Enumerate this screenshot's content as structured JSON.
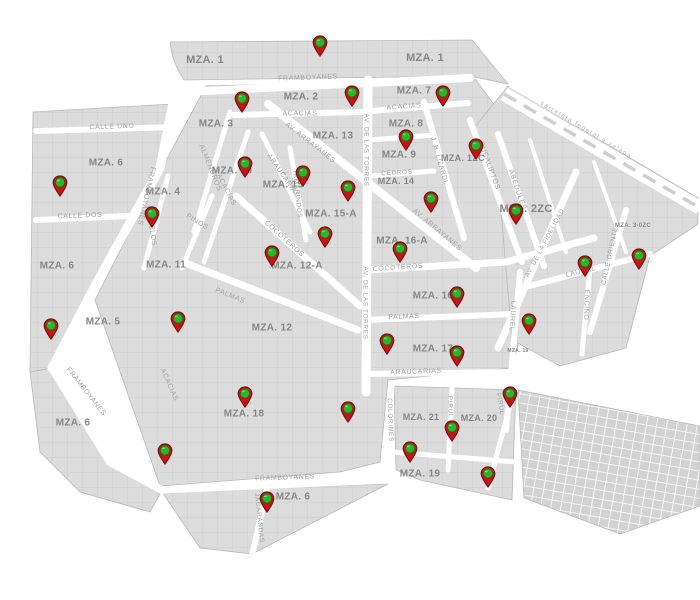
{
  "map": {
    "colors": {
      "background": "#ffffff",
      "block_fill": "#dcdcdc",
      "block_stroke": "#b8b8b8",
      "parcel_line": "#d3d3d3",
      "street": "#ffffff",
      "grid_cell": "#d2d2d2",
      "block_label": "#868686",
      "street_label": "#a2a2a2",
      "highway_label": "#b5b5b5",
      "pin_body": "#c81414",
      "pin_border": "#7d0f0f",
      "pin_dot": "#2db32d",
      "pin_dot_border": "#157a15"
    },
    "highway_label": {
      "text": "carretera federal a xalapa",
      "x": 586,
      "y": 130,
      "rotation": 31
    },
    "block_labels": [
      {
        "text": "MZA. 1",
        "x": 205,
        "y": 60,
        "size": 11
      },
      {
        "text": "MZA. 1",
        "x": 425,
        "y": 58,
        "size": 11
      },
      {
        "text": "MZA. 2",
        "x": 301,
        "y": 97,
        "size": 10
      },
      {
        "text": "MZA. 7",
        "x": 414,
        "y": 91,
        "size": 10
      },
      {
        "text": "MZA. 3",
        "x": 216,
        "y": 124,
        "size": 10
      },
      {
        "text": "MZA. 13",
        "x": 333,
        "y": 136,
        "size": 10
      },
      {
        "text": "MZA. 8",
        "x": 406,
        "y": 124,
        "size": 10
      },
      {
        "text": "MZA. 6",
        "x": 106,
        "y": 163,
        "size": 10
      },
      {
        "text": "MZA. 9",
        "x": 399,
        "y": 155,
        "size": 10
      },
      {
        "text": "MZA. 1ZC",
        "x": 463,
        "y": 158,
        "size": 9
      },
      {
        "text": "MZA. 4",
        "x": 163,
        "y": 192,
        "size": 10
      },
      {
        "text": "MZA. 10",
        "x": 232,
        "y": 171,
        "size": 10
      },
      {
        "text": "MZA. 15",
        "x": 283,
        "y": 185,
        "size": 10
      },
      {
        "text": "MZA. 14",
        "x": 396,
        "y": 181,
        "size": 9
      },
      {
        "text": "MZA. 2ZC",
        "x": 526,
        "y": 209,
        "size": 11
      },
      {
        "text": "MZA. 15-A",
        "x": 331,
        "y": 214,
        "size": 10
      },
      {
        "text": "MZA. 16-A",
        "x": 402,
        "y": 241,
        "size": 10
      },
      {
        "text": "MZA. 6",
        "x": 57,
        "y": 266,
        "size": 10
      },
      {
        "text": "MZA. 11",
        "x": 166,
        "y": 265,
        "size": 10
      },
      {
        "text": "MZA. 12-A",
        "x": 297,
        "y": 266,
        "size": 10
      },
      {
        "text": "MZA. 3-0ZC",
        "x": 633,
        "y": 226,
        "size": 6
      },
      {
        "text": "MZA. 16",
        "x": 433,
        "y": 296,
        "size": 10
      },
      {
        "text": "MZA. 5",
        "x": 103,
        "y": 322,
        "size": 10
      },
      {
        "text": "MZA. 12",
        "x": 272,
        "y": 328,
        "size": 10
      },
      {
        "text": "MZA. 17",
        "x": 433,
        "y": 349,
        "size": 10
      },
      {
        "text": "MZA. 19",
        "x": 518,
        "y": 351,
        "size": 5
      },
      {
        "text": "MZA. 6",
        "x": 73,
        "y": 423,
        "size": 10
      },
      {
        "text": "MZA. 18",
        "x": 244,
        "y": 414,
        "size": 10
      },
      {
        "text": "MZA. 21",
        "x": 421,
        "y": 417,
        "size": 9
      },
      {
        "text": "MZA. 20",
        "x": 479,
        "y": 418,
        "size": 9
      },
      {
        "text": "MZA. 19",
        "x": 420,
        "y": 474,
        "size": 10
      },
      {
        "text": "MZA. 6",
        "x": 293,
        "y": 497,
        "size": 10
      }
    ],
    "street_labels": [
      {
        "text": "FRAMBOYANES",
        "x": 308,
        "y": 78,
        "rotation": -2
      },
      {
        "text": "ACACIAS",
        "x": 300,
        "y": 114,
        "rotation": 0
      },
      {
        "text": "ACACIAS",
        "x": 404,
        "y": 107,
        "rotation": -4
      },
      {
        "text": "CALLE UNO",
        "x": 112,
        "y": 127,
        "rotation": -2
      },
      {
        "text": "CALLE DOS",
        "x": 80,
        "y": 216,
        "rotation": -2
      },
      {
        "text": "FRAMBOYANES",
        "x": 146,
        "y": 196,
        "rotation": 103
      },
      {
        "text": "CIRUELOS",
        "x": 151,
        "y": 226,
        "rotation": 82
      },
      {
        "text": "PINOS",
        "x": 197,
        "y": 222,
        "rotation": 32
      },
      {
        "text": "ALMENDROS",
        "x": 210,
        "y": 168,
        "rotation": 68
      },
      {
        "text": "ACACIAS",
        "x": 226,
        "y": 190,
        "rotation": 62
      },
      {
        "text": "ARAUCARIAS",
        "x": 283,
        "y": 176,
        "rotation": 55
      },
      {
        "text": "TAMARINDOS",
        "x": 297,
        "y": 194,
        "rotation": 84,
        "size": 6.5
      },
      {
        "text": "AV. ARRAYANES",
        "x": 310,
        "y": 143,
        "rotation": 38
      },
      {
        "text": "AV. ARRAYANES",
        "x": 437,
        "y": 230,
        "rotation": 40
      },
      {
        "text": "COCOTEROS",
        "x": 284,
        "y": 239,
        "rotation": 42
      },
      {
        "text": "PALMAS",
        "x": 230,
        "y": 296,
        "rotation": 22
      },
      {
        "text": "AV. DE LAS TORRES",
        "x": 366,
        "y": 150,
        "rotation": 90,
        "size": 6.5
      },
      {
        "text": "AV. DE LAS TORRES",
        "x": 365,
        "y": 303,
        "rotation": 90,
        "size": 6.5
      },
      {
        "text": "CEDROS",
        "x": 397,
        "y": 173,
        "rotation": -3,
        "size": 6.5
      },
      {
        "text": "COCOTEROS",
        "x": 398,
        "y": 268,
        "rotation": -4
      },
      {
        "text": "PALMAS",
        "x": 404,
        "y": 317,
        "rotation": -2
      },
      {
        "text": "ARAUCARIAS",
        "x": 416,
        "y": 372,
        "rotation": -2
      },
      {
        "text": "J. B. LIZARDI",
        "x": 439,
        "y": 160,
        "rotation": 74,
        "size": 6.5
      },
      {
        "text": "EUCALIPTOS",
        "x": 489,
        "y": 166,
        "rotation": 70
      },
      {
        "text": "ABEDULES",
        "x": 517,
        "y": 190,
        "rotation": 71
      },
      {
        "text": "AV. DE LA FIDELIDAD",
        "x": 545,
        "y": 243,
        "rotation": -62,
        "size": 6.5
      },
      {
        "text": "CALLE ORIENTE",
        "x": 610,
        "y": 256,
        "rotation": -78,
        "size": 6.5
      },
      {
        "text": "LAUREL",
        "x": 581,
        "y": 272,
        "rotation": -14
      },
      {
        "text": "LAUREL",
        "x": 512,
        "y": 316,
        "rotation": 94
      },
      {
        "text": "ENCINO",
        "x": 586,
        "y": 305,
        "rotation": 92
      },
      {
        "text": "COLORINES",
        "x": 390,
        "y": 420,
        "rotation": 88,
        "size": 6.5
      },
      {
        "text": "PIRUL",
        "x": 450,
        "y": 407,
        "rotation": 88,
        "size": 6.5
      },
      {
        "text": "PIRUL",
        "x": 500,
        "y": 404,
        "rotation": 78,
        "size": 6.5
      },
      {
        "text": "JACARANDAS",
        "x": 259,
        "y": 518,
        "rotation": 84,
        "size": 6.5
      },
      {
        "text": "FRAMBOYANES",
        "x": 86,
        "y": 392,
        "rotation": 52
      },
      {
        "text": "ACACIAS",
        "x": 169,
        "y": 385,
        "rotation": 66
      },
      {
        "text": "FRAMBOYANES",
        "x": 285,
        "y": 478,
        "rotation": -2
      }
    ],
    "pins": [
      {
        "x": 320,
        "y": 42
      },
      {
        "x": 242,
        "y": 98
      },
      {
        "x": 352,
        "y": 92
      },
      {
        "x": 443,
        "y": 92
      },
      {
        "x": 406,
        "y": 136
      },
      {
        "x": 476,
        "y": 145
      },
      {
        "x": 60,
        "y": 182
      },
      {
        "x": 245,
        "y": 163
      },
      {
        "x": 303,
        "y": 172
      },
      {
        "x": 348,
        "y": 187
      },
      {
        "x": 152,
        "y": 213
      },
      {
        "x": 431,
        "y": 198
      },
      {
        "x": 516,
        "y": 210
      },
      {
        "x": 325,
        "y": 233
      },
      {
        "x": 272,
        "y": 252
      },
      {
        "x": 400,
        "y": 248
      },
      {
        "x": 585,
        "y": 262
      },
      {
        "x": 639,
        "y": 255
      },
      {
        "x": 457,
        "y": 293
      },
      {
        "x": 529,
        "y": 320
      },
      {
        "x": 51,
        "y": 325
      },
      {
        "x": 178,
        "y": 318
      },
      {
        "x": 387,
        "y": 340
      },
      {
        "x": 457,
        "y": 352
      },
      {
        "x": 245,
        "y": 393
      },
      {
        "x": 510,
        "y": 393
      },
      {
        "x": 348,
        "y": 408
      },
      {
        "x": 452,
        "y": 427
      },
      {
        "x": 410,
        "y": 448
      },
      {
        "x": 165,
        "y": 450
      },
      {
        "x": 488,
        "y": 473
      },
      {
        "x": 267,
        "y": 498
      }
    ]
  }
}
